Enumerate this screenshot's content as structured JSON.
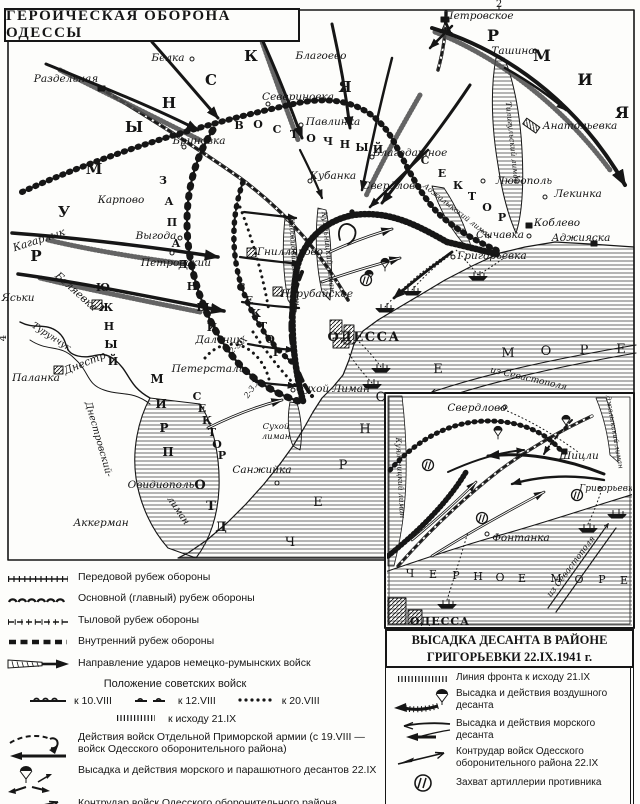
{
  "page": {
    "title": "ГЕРОИЧЕСКАЯ ОБОРОНА ОДЕССЫ"
  },
  "colors": {
    "ink": "#161616",
    "paper": "#fdfdfb"
  },
  "map": {
    "labels": [
      {
        "t": "Раздельная",
        "x": 66,
        "y": 82
      },
      {
        "t": "Белка",
        "x": 168,
        "y": 61
      },
      {
        "t": "Бриновка",
        "x": 199,
        "y": 144
      },
      {
        "t": "Севериновка",
        "x": 298,
        "y": 100
      },
      {
        "t": "Павлинка",
        "x": 333,
        "y": 125
      },
      {
        "t": "Благоево",
        "x": 321,
        "y": 59
      },
      {
        "t": "Петровское",
        "x": 479,
        "y": 19
      },
      {
        "t": "Ташино",
        "x": 513,
        "y": 54
      },
      {
        "t": "Анатольевка",
        "x": 580,
        "y": 129
      },
      {
        "t": "Любополь",
        "x": 524,
        "y": 184
      },
      {
        "t": "Лекинка",
        "x": 578,
        "y": 197
      },
      {
        "t": "Коблево",
        "x": 557,
        "y": 226
      },
      {
        "t": "Сычавка",
        "x": 500,
        "y": 238
      },
      {
        "t": "Аджияска",
        "x": 581,
        "y": 241
      },
      {
        "t": "Григорьевка",
        "x": 492,
        "y": 259
      },
      {
        "t": "Благодатное",
        "x": 410,
        "y": 156
      },
      {
        "t": "Кубанка",
        "x": 333,
        "y": 179
      },
      {
        "t": "Свердлово",
        "x": 392,
        "y": 189
      },
      {
        "t": "Карпово",
        "x": 121,
        "y": 203
      },
      {
        "t": "Кагарлык",
        "x": 40,
        "y": 243,
        "r": -18
      },
      {
        "t": "Выгода",
        "x": 156,
        "y": 239
      },
      {
        "t": "Петровский",
        "x": 176,
        "y": 266
      },
      {
        "t": "Беляевка",
        "x": 74,
        "y": 294,
        "r": 42
      },
      {
        "t": "Яськи",
        "x": 18,
        "y": 301
      },
      {
        "t": "Турунчук",
        "x": 50,
        "y": 339,
        "r": 33,
        "s": 9
      },
      {
        "t": "Днестр",
        "x": 86,
        "y": 366,
        "r": -22
      },
      {
        "t": "Паланка",
        "x": 36,
        "y": 381
      },
      {
        "t": "Гнилляково",
        "x": 290,
        "y": 255
      },
      {
        "t": "Нерубайское",
        "x": 317,
        "y": 297
      },
      {
        "t": "ОДЕССА",
        "x": 364,
        "y": 341,
        "s": 13,
        "b": true,
        "i": false,
        "ls": 1.5
      },
      {
        "t": "Дальник",
        "x": 219,
        "y": 343
      },
      {
        "t": "Петерсталь",
        "x": 208,
        "y": 372
      },
      {
        "t": "Сухой Лиман",
        "x": 333,
        "y": 392
      },
      {
        "t": "Сухой",
        "x": 276,
        "y": 429,
        "s": 8.5
      },
      {
        "t": "лиман",
        "x": 276,
        "y": 439,
        "s": 8.5
      },
      {
        "t": "Санжийка",
        "x": 262,
        "y": 473
      },
      {
        "t": "Овидиополь",
        "x": 161,
        "y": 488
      },
      {
        "t": "Аккерман",
        "x": 101,
        "y": 526
      },
      {
        "t": "из Севастополя",
        "x": 528,
        "y": 381,
        "r": 13,
        "s": 9
      },
      {
        "t": "Днестровский-",
        "x": 96,
        "y": 440,
        "r": 74,
        "s": 9.5
      },
      {
        "t": "лиман",
        "x": 176,
        "y": 512,
        "r": 56,
        "s": 9.5
      },
      {
        "t": "2-3.X",
        "x": 240,
        "y": 347,
        "r": -42,
        "s": 8
      },
      {
        "t": "2-3.X",
        "x": 254,
        "y": 390,
        "r": -55,
        "s": 8
      },
      {
        "t": "Хаджибейский лиман",
        "x": 292,
        "y": 262,
        "r": 86,
        "s": 7.5
      },
      {
        "t": "Куяльницкий лиман",
        "x": 326,
        "y": 252,
        "r": 84,
        "s": 7.5
      },
      {
        "t": "Аджалыкский лиман",
        "x": 456,
        "y": 213,
        "r": 38,
        "s": 7.5
      },
      {
        "t": "Тилигульский лиман",
        "x": 510,
        "y": 143,
        "r": 84,
        "s": 7.5
      },
      {
        "t": "Ч",
        "x": 290,
        "y": 546,
        "s": 13,
        "i": false
      },
      {
        "t": "Е",
        "x": 318,
        "y": 506,
        "s": 13,
        "i": false
      },
      {
        "t": "Р",
        "x": 343,
        "y": 469,
        "s": 13,
        "i": false
      },
      {
        "t": "Н",
        "x": 365,
        "y": 433,
        "s": 13,
        "i": false
      },
      {
        "t": "О",
        "x": 381,
        "y": 401,
        "s": 13,
        "i": false
      },
      {
        "t": "Е",
        "x": 438,
        "y": 373,
        "s": 13,
        "i": false
      },
      {
        "t": "М",
        "x": 508,
        "y": 357,
        "s": 13,
        "i": false
      },
      {
        "t": "О",
        "x": 546,
        "y": 355,
        "s": 13,
        "i": false
      },
      {
        "t": "Р",
        "x": 584,
        "y": 354,
        "s": 13,
        "i": false
      },
      {
        "t": "Е",
        "x": 621,
        "y": 353,
        "s": 13,
        "i": false
      },
      {
        "t": "Р",
        "x": 36,
        "y": 261,
        "s": 15,
        "b": true,
        "i": false
      },
      {
        "t": "У",
        "x": 64,
        "y": 217,
        "s": 15,
        "b": true,
        "i": false
      },
      {
        "t": "М",
        "x": 94,
        "y": 174,
        "s": 15,
        "b": true,
        "i": false
      },
      {
        "t": "Ы",
        "x": 134,
        "y": 132,
        "s": 15,
        "b": true,
        "i": false
      },
      {
        "t": "Н",
        "x": 169,
        "y": 108,
        "s": 15,
        "b": true,
        "i": false
      },
      {
        "t": "С",
        "x": 211,
        "y": 85,
        "s": 15,
        "b": true,
        "i": false
      },
      {
        "t": "К",
        "x": 251,
        "y": 61,
        "s": 15,
        "b": true,
        "i": false
      },
      {
        "t": "А",
        "x": 289,
        "y": 38,
        "s": 15,
        "b": true,
        "i": false
      },
      {
        "t": "Я",
        "x": 345,
        "y": 92,
        "s": 15,
        "b": true,
        "i": false
      },
      {
        "t": "А",
        "x": 446,
        "y": 33,
        "s": 16,
        "b": true,
        "i": false
      },
      {
        "t": "Р",
        "x": 493,
        "y": 41,
        "s": 16,
        "b": true,
        "i": false
      },
      {
        "t": "М",
        "x": 542,
        "y": 61,
        "s": 16,
        "b": true,
        "i": false
      },
      {
        "t": "И",
        "x": 585,
        "y": 85,
        "s": 16,
        "b": true,
        "i": false
      },
      {
        "t": "Я",
        "x": 622,
        "y": 118,
        "s": 16,
        "b": true,
        "i": false
      },
      {
        "t": "В",
        "x": 239,
        "y": 129,
        "s": 11,
        "b": true,
        "i": false
      },
      {
        "t": "О",
        "x": 258,
        "y": 128,
        "s": 11,
        "b": true,
        "i": false
      },
      {
        "t": "С",
        "x": 277,
        "y": 133,
        "s": 11,
        "b": true,
        "i": false
      },
      {
        "t": "Т",
        "x": 294,
        "y": 138,
        "s": 11,
        "b": true,
        "i": false
      },
      {
        "t": "О",
        "x": 311,
        "y": 142,
        "s": 11,
        "b": true,
        "i": false
      },
      {
        "t": "Ч",
        "x": 328,
        "y": 145,
        "s": 11,
        "b": true,
        "i": false
      },
      {
        "t": "Н",
        "x": 345,
        "y": 148,
        "s": 11,
        "b": true,
        "i": false
      },
      {
        "t": "Ы",
        "x": 362,
        "y": 151,
        "s": 11,
        "b": true,
        "i": false
      },
      {
        "t": "Й",
        "x": 378,
        "y": 153,
        "s": 11,
        "b": true,
        "i": false
      },
      {
        "t": "С",
        "x": 425,
        "y": 164,
        "s": 11,
        "b": true,
        "i": false
      },
      {
        "t": "Е",
        "x": 442,
        "y": 177,
        "s": 11,
        "b": true,
        "i": false
      },
      {
        "t": "К",
        "x": 458,
        "y": 189,
        "s": 11,
        "b": true,
        "i": false
      },
      {
        "t": "Т",
        "x": 472,
        "y": 200,
        "s": 11,
        "b": true,
        "i": false
      },
      {
        "t": "О",
        "x": 487,
        "y": 211,
        "s": 11,
        "b": true,
        "i": false
      },
      {
        "t": "Р",
        "x": 502,
        "y": 221,
        "s": 11,
        "b": true,
        "i": false
      },
      {
        "t": "З",
        "x": 163,
        "y": 184,
        "s": 11,
        "b": true,
        "i": false
      },
      {
        "t": "А",
        "x": 169,
        "y": 205,
        "s": 11,
        "b": true,
        "i": false
      },
      {
        "t": "П",
        "x": 172,
        "y": 226,
        "s": 11,
        "b": true,
        "i": false
      },
      {
        "t": "А",
        "x": 176,
        "y": 247,
        "s": 11,
        "b": true,
        "i": false
      },
      {
        "t": "Д",
        "x": 183,
        "y": 268,
        "s": 11,
        "b": true,
        "i": false
      },
      {
        "t": "Н",
        "x": 192,
        "y": 290,
        "s": 11,
        "b": true,
        "i": false
      },
      {
        "t": "Ы",
        "x": 203,
        "y": 311,
        "s": 11,
        "b": true,
        "i": false
      },
      {
        "t": "Й",
        "x": 212,
        "y": 331,
        "s": 11,
        "b": true,
        "i": false
      },
      {
        "t": "С",
        "x": 241,
        "y": 291,
        "s": 11,
        "b": true,
        "i": false
      },
      {
        "t": "Е",
        "x": 249,
        "y": 304,
        "s": 11,
        "b": true,
        "i": false
      },
      {
        "t": "К",
        "x": 256,
        "y": 317,
        "s": 11,
        "b": true,
        "i": false
      },
      {
        "t": "Т",
        "x": 263,
        "y": 330,
        "s": 11,
        "b": true,
        "i": false
      },
      {
        "t": "О",
        "x": 270,
        "y": 343,
        "s": 11,
        "b": true,
        "i": false
      },
      {
        "t": "Р",
        "x": 277,
        "y": 356,
        "s": 11,
        "b": true,
        "i": false
      },
      {
        "t": "Ю",
        "x": 103,
        "y": 291,
        "s": 11,
        "b": true,
        "i": false
      },
      {
        "t": "Ж",
        "x": 106,
        "y": 311,
        "s": 11,
        "b": true,
        "i": false
      },
      {
        "t": "Н",
        "x": 109,
        "y": 330,
        "s": 11,
        "b": true,
        "i": false
      },
      {
        "t": "Ы",
        "x": 111,
        "y": 348,
        "s": 11,
        "b": true,
        "i": false
      },
      {
        "t": "Й",
        "x": 113,
        "y": 365,
        "s": 11,
        "b": true,
        "i": false
      },
      {
        "t": "С",
        "x": 197,
        "y": 400,
        "s": 11,
        "b": true,
        "i": false
      },
      {
        "t": "Е",
        "x": 202,
        "y": 412,
        "s": 11,
        "b": true,
        "i": false
      },
      {
        "t": "К",
        "x": 207,
        "y": 424,
        "s": 11,
        "b": true,
        "i": false
      },
      {
        "t": "Т",
        "x": 212,
        "y": 436,
        "s": 11,
        "b": true,
        "i": false
      },
      {
        "t": "О",
        "x": 217,
        "y": 448,
        "s": 11,
        "b": true,
        "i": false
      },
      {
        "t": "Р",
        "x": 222,
        "y": 459,
        "s": 11,
        "b": true,
        "i": false
      },
      {
        "t": "М",
        "x": 157,
        "y": 383,
        "s": 12,
        "b": true,
        "i": false
      },
      {
        "t": "И",
        "x": 161,
        "y": 408,
        "s": 12,
        "b": true,
        "i": false
      },
      {
        "t": "Р",
        "x": 164,
        "y": 432,
        "s": 12,
        "b": true,
        "i": false
      },
      {
        "t": "П",
        "x": 168,
        "y": 456,
        "s": 12,
        "b": true,
        "i": false
      },
      {
        "t": "О",
        "x": 200,
        "y": 489,
        "s": 13,
        "b": true,
        "i": false
      },
      {
        "t": "Т",
        "x": 211,
        "y": 510,
        "s": 13,
        "b": true,
        "i": false
      },
      {
        "t": "Д",
        "x": 221,
        "y": 531,
        "s": 13,
        "b": true,
        "i": false
      },
      {
        "t": "2",
        "x": 499,
        "y": 7,
        "s": 10,
        "i": false
      },
      {
        "t": "4",
        "x": 6,
        "y": 338,
        "s": 10,
        "i": false,
        "r": -90
      }
    ]
  },
  "inset": {
    "labels": [
      {
        "t": "Свердлово",
        "x": 477,
        "y": 411
      },
      {
        "t": "Шицли",
        "x": 579,
        "y": 459
      },
      {
        "t": "Григорьевка",
        "x": 609,
        "y": 491,
        "s": 9
      },
      {
        "t": "Фонтанка",
        "x": 521,
        "y": 541
      },
      {
        "t": "ОДЕССА",
        "x": 440,
        "y": 625,
        "s": 11,
        "b": true,
        "i": false,
        "ls": 1
      },
      {
        "t": "из Севастополя",
        "x": 573,
        "y": 568,
        "r": -53,
        "s": 8.5
      },
      {
        "t": "Куяльницкий лиман",
        "x": 398,
        "y": 478,
        "r": 87,
        "s": 7.5
      },
      {
        "t": "Аджалыкский лиман",
        "x": 612,
        "y": 430,
        "r": 80,
        "s": 7
      },
      {
        "t": "Ч",
        "x": 410,
        "y": 577,
        "s": 11,
        "i": false
      },
      {
        "t": "Е",
        "x": 433,
        "y": 578,
        "s": 11,
        "i": false
      },
      {
        "t": "Р",
        "x": 456,
        "y": 579,
        "s": 11,
        "i": false
      },
      {
        "t": "Н",
        "x": 478,
        "y": 580,
        "s": 11,
        "i": false
      },
      {
        "t": "О",
        "x": 500,
        "y": 581,
        "s": 11,
        "i": false
      },
      {
        "t": "Е",
        "x": 522,
        "y": 582,
        "s": 11,
        "i": false
      },
      {
        "t": "М",
        "x": 556,
        "y": 582,
        "s": 11,
        "i": false
      },
      {
        "t": "О",
        "x": 579,
        "y": 583,
        "s": 11,
        "i": false
      },
      {
        "t": "Р",
        "x": 602,
        "y": 583,
        "s": 11,
        "i": false
      },
      {
        "t": "Е",
        "x": 624,
        "y": 584,
        "s": 11,
        "i": false
      }
    ],
    "title_line1": "ВЫСАДКА ДЕСАНТА В РАЙОНЕ",
    "title_line2": "ГРИГОРЬЕВКИ 22.IX.1941 г."
  },
  "legend_left": {
    "items": [
      {
        "symbol": "forward-line",
        "label": "Передовой рубеж обороны"
      },
      {
        "symbol": "main-line",
        "label": "Основной (главный) рубеж обороны"
      },
      {
        "symbol": "rear-line",
        "label": "Тыловой рубеж обороны"
      },
      {
        "symbol": "inner-line",
        "label": "Внутренний рубеж обороны"
      },
      {
        "symbol": "enemy-attack-arrow",
        "label": "Направление ударов немецко-румынских войск"
      }
    ],
    "soviet_positions_header": "Положение советских войск",
    "date_items": [
      {
        "symbol": "pos-10",
        "label": "к 10.VIII"
      },
      {
        "symbol": "pos-12",
        "label": "к 12.VIII"
      },
      {
        "symbol": "pos-20",
        "label": "к 20.VIII"
      }
    ],
    "date_item_21": {
      "symbol": "pos-21",
      "label": "к исходу 21.IX"
    },
    "items2": [
      {
        "symbol": "primorsk-army",
        "label": "Действия войск Отдельной Приморской армии (с 19.VIII — войск Одесского оборонительного района)"
      },
      {
        "symbol": "landing",
        "label": "Высадка и действия морского и парашютного десантов 22.IX"
      },
      {
        "symbol": "counterattack",
        "label": "Контрудар войск Одесского оборонительного района"
      }
    ]
  },
  "legend_right": {
    "items": [
      {
        "symbol": "front-line-21",
        "label": "Линия фронта к исходу 21.IX"
      },
      {
        "symbol": "air-landing",
        "label": "Высадка и действия воздушного десанта"
      },
      {
        "symbol": "sea-landing",
        "label": "Высадка и действия морского десанта"
      },
      {
        "symbol": "counterattack-22",
        "label": "Контрудар войск Одесского оборонительного района 22.IX"
      },
      {
        "symbol": "artillery-capture",
        "label": "Захват артиллерии противника"
      }
    ]
  }
}
